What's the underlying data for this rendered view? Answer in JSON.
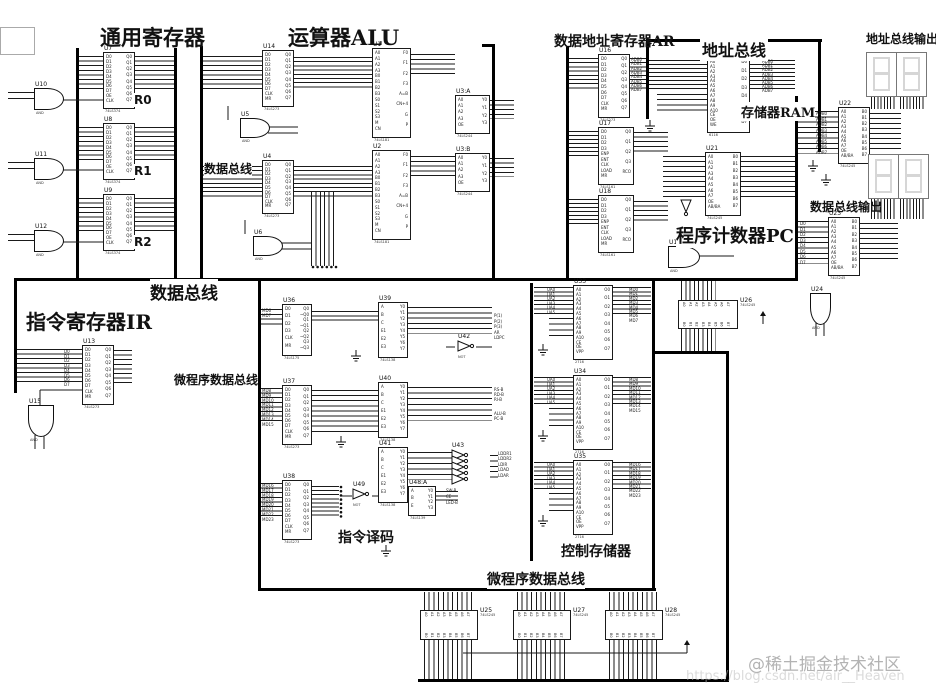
{
  "sections": {
    "gen_reg": "通用寄存器",
    "alu": "运算器ALU",
    "ar": "数据地址寄存器AR",
    "addr_bus": "地址总线",
    "addr_out": "地址总线输出",
    "ram": "存储器RAM",
    "data_bus_small": "数据总线",
    "pc": "程序计数器PC",
    "data_out": "数据总线输出",
    "data_bus": "数据总线",
    "ir": "指令寄存器IR",
    "micro_bus_left": "微程序数据总线",
    "decode": "指令译码",
    "ctrl_store": "控制存储器",
    "micro_bus_bottom": "微程序数据总线",
    "r0": "R0",
    "r1": "R1",
    "r2": "R2"
  },
  "watermark": {
    "community": "@稀土掘金技术社区",
    "url": "https://blog.csdn.net/air__Heaven"
  },
  "chips": [
    {
      "ref": "U7",
      "part": "74LS374",
      "x": 103,
      "y": 52,
      "w": 30,
      "h": 55,
      "lp": "D:0-7,OE,CLK",
      "rp": "Q:0-7"
    },
    {
      "ref": "U8",
      "part": "74LS374",
      "x": 103,
      "y": 123,
      "w": 30,
      "h": 55,
      "lp": "D:0-7,OE,CLK",
      "rp": "Q:0-7"
    },
    {
      "ref": "U9",
      "part": "74LS374",
      "x": 103,
      "y": 194,
      "w": 30,
      "h": 55,
      "lp": "D:0-7,OE,CLK",
      "rp": "Q:0-7"
    },
    {
      "ref": "U14",
      "part": "74LS273",
      "x": 262,
      "y": 50,
      "w": 30,
      "h": 55,
      "lp": "D:0-7,CLK,MR",
      "rp": "Q:0-7"
    },
    {
      "ref": "U4",
      "part": "74LS273",
      "x": 262,
      "y": 160,
      "w": 30,
      "h": 52,
      "lp": "D:0-7,CLK,MR",
      "rp": "Q:0-7"
    },
    {
      "ref": "U1",
      "part": "74LS181",
      "x": 372,
      "y": 48,
      "w": 37,
      "h": 88,
      "lp": "A:0-3,B:0-3,S:0-3,M,CN",
      "rp": "F:0-3,A=B,CN+4,G,P"
    },
    {
      "ref": "U2",
      "part": "74LS181",
      "x": 372,
      "y": 150,
      "w": 37,
      "h": 88,
      "lp": "A:0-3,B:0-3,S:0-3,M,CN",
      "rp": "F:0-3,A=B,CN+4,G,P"
    },
    {
      "ref": "U3:A",
      "part": "74LS244",
      "x": 455,
      "y": 95,
      "w": 33,
      "h": 37,
      "lp": "A:0-3,OE",
      "rp": "Y:0-3"
    },
    {
      "ref": "U3:B",
      "part": "74LS244",
      "x": 455,
      "y": 153,
      "w": 33,
      "h": 37,
      "lp": "A:0-3,OE",
      "rp": "Y:0-3"
    },
    {
      "ref": "U16",
      "part": "74LS273",
      "x": 598,
      "y": 54,
      "w": 30,
      "h": 62,
      "lp": "D:0-7,CLK,MR",
      "rp": "Q:0-7"
    },
    {
      "ref": "U20",
      "part": "6116",
      "x": 707,
      "y": 57,
      "w": 41,
      "h": 74,
      "lp": "A:0-10,CE,OE,WE",
      "rp": "D:0-7"
    },
    {
      "ref": "U17",
      "part": "74LS161",
      "x": 598,
      "y": 127,
      "w": 34,
      "h": 56,
      "lp": "D:0-3,ENP,ENT,CLK,LOAD,MR",
      "rp": "Q:0-3,RCO"
    },
    {
      "ref": "U18",
      "part": "74LS161",
      "x": 598,
      "y": 195,
      "w": 34,
      "h": 56,
      "lp": "D:0-3,ENP,ENT,CLK,LOAD,MR",
      "rp": "Q:0-3,RCO"
    },
    {
      "ref": "U21",
      "part": "74LS245",
      "x": 705,
      "y": 152,
      "w": 34,
      "h": 62,
      "lp": "A:0-7,OE,AB/BA",
      "rp": "B:0-7"
    },
    {
      "ref": "U22",
      "part": "74LS245",
      "x": 838,
      "y": 107,
      "w": 30,
      "h": 55,
      "lp": "A:0-7,OE,AB/BA",
      "rp": "B:0-7"
    },
    {
      "ref": "U23",
      "part": "74LS245",
      "x": 828,
      "y": 217,
      "w": 30,
      "h": 57,
      "lp": "A:0-7,OE,AB/BA",
      "rp": "B:0-7"
    },
    {
      "ref": "U13",
      "part": "74LS273",
      "x": 82,
      "y": 345,
      "w": 30,
      "h": 58,
      "lp": "D:0-7,CLK,MR",
      "rp": "Q:0-7"
    },
    {
      "ref": "U36",
      "part": "74LS175",
      "x": 282,
      "y": 304,
      "w": 28,
      "h": 50,
      "lp": "D:0-3,CLK,MR",
      "rp": "Q0,~Q0,Q1,~Q1,Q2,~Q2,Q3,~Q3"
    },
    {
      "ref": "U37",
      "part": "74LS273",
      "x": 282,
      "y": 385,
      "w": 28,
      "h": 58,
      "lp": "D:0-7,CLK,MR",
      "rp": "Q:0-7"
    },
    {
      "ref": "U38",
      "part": "74LS273",
      "x": 282,
      "y": 480,
      "w": 28,
      "h": 58,
      "lp": "D:0-7,CLK,MR",
      "rp": "Q:0-7"
    },
    {
      "ref": "U39",
      "part": "74LS138",
      "x": 378,
      "y": 302,
      "w": 28,
      "h": 54,
      "lp": "A,B,C,E1,E2,E3",
      "rp": "Y:0-7"
    },
    {
      "ref": "U40",
      "part": "74LS138",
      "x": 378,
      "y": 382,
      "w": 28,
      "h": 54,
      "lp": "A,B,C,E1,E2,E3",
      "rp": "Y:0-7"
    },
    {
      "ref": "U41",
      "part": "74LS138",
      "x": 378,
      "y": 447,
      "w": 28,
      "h": 54,
      "lp": "A,B,C,E1,E2,E3",
      "rp": "Y:0-7"
    },
    {
      "ref": "U48:A",
      "part": "74LS139",
      "x": 408,
      "y": 486,
      "w": 26,
      "h": 28,
      "lp": "A,B,E",
      "rp": "Y:0-3"
    },
    {
      "ref": "U33",
      "part": "2716",
      "x": 573,
      "y": 285,
      "w": 38,
      "h": 73,
      "lp": "A:0-10,CE,OE,VPP",
      "rp": "O:0-7"
    },
    {
      "ref": "U34",
      "part": "2716",
      "x": 573,
      "y": 375,
      "w": 38,
      "h": 73,
      "lp": "A:0-10,CE,OE,VPP",
      "rp": "O:0-7"
    },
    {
      "ref": "U35",
      "part": "2716",
      "x": 573,
      "y": 460,
      "w": 38,
      "h": 73,
      "lp": "A:0-10,CE,OE,VPP",
      "rp": "O:0-7"
    },
    {
      "ref": "U26",
      "part": "74LS245",
      "x": 678,
      "y": 300,
      "w": 58,
      "h": 27,
      "dir": "h",
      "tp": "A:0-7",
      "bp": "B:0-7"
    },
    {
      "ref": "U25",
      "part": "74LS245",
      "x": 420,
      "y": 610,
      "w": 56,
      "h": 28,
      "dir": "h",
      "tp": "A:0-7",
      "bp": "B:0-7"
    },
    {
      "ref": "U27",
      "part": "74LS245",
      "x": 513,
      "y": 610,
      "w": 56,
      "h": 28,
      "dir": "h",
      "tp": "A:0-7",
      "bp": "B:0-7"
    },
    {
      "ref": "U28",
      "part": "74LS245",
      "x": 605,
      "y": 610,
      "w": 56,
      "h": 28,
      "dir": "h",
      "tp": "A:0-7",
      "bp": "B:0-7"
    }
  ],
  "gates": [
    {
      "ref": "U10",
      "sub": "AND",
      "x": 34,
      "y": 88,
      "w": 28,
      "h": 20,
      "dir": "r"
    },
    {
      "ref": "U11",
      "sub": "AND",
      "x": 34,
      "y": 158,
      "w": 28,
      "h": 20,
      "dir": "r"
    },
    {
      "ref": "U12",
      "sub": "AND",
      "x": 34,
      "y": 230,
      "w": 28,
      "h": 20,
      "dir": "r"
    },
    {
      "ref": "U5",
      "sub": "AND",
      "x": 240,
      "y": 118,
      "w": 28,
      "h": 18,
      "dir": "r"
    },
    {
      "ref": "U6",
      "sub": "AND",
      "x": 253,
      "y": 236,
      "w": 28,
      "h": 18,
      "dir": "r"
    },
    {
      "ref": "U15",
      "sub": "AND",
      "x": 28,
      "y": 405,
      "w": 24,
      "h": 30,
      "dir": "d"
    },
    {
      "ref": "U19",
      "sub": "AND",
      "x": 668,
      "y": 246,
      "w": 30,
      "h": 20,
      "dir": "r"
    },
    {
      "ref": "U24",
      "sub": "AND",
      "x": 810,
      "y": 293,
      "w": 19,
      "h": 30,
      "dir": "d"
    }
  ],
  "nots": [
    {
      "ref": "U42",
      "sub": "NOT",
      "x": 458,
      "y": 341,
      "dir": "r"
    },
    {
      "ref": "U49",
      "sub": "NOT",
      "x": 353,
      "y": 489,
      "dir": "r"
    },
    {
      "ref": "U43",
      "sub": "NOT",
      "x": 452,
      "y": 450,
      "dir": "r"
    },
    {
      "ref": "",
      "sub": "",
      "x": 452,
      "y": 456,
      "dir": "r"
    },
    {
      "ref": "",
      "sub": "",
      "x": 452,
      "y": 462,
      "dir": "r"
    },
    {
      "ref": "",
      "sub": "",
      "x": 452,
      "y": 468,
      "dir": "r"
    },
    {
      "ref": "",
      "sub": "",
      "x": 452,
      "y": 474,
      "dir": "r"
    },
    {
      "ref": "",
      "sub": "",
      "x": 681,
      "y": 200,
      "dir": "d"
    }
  ],
  "signal_groups": [
    {
      "x": 631,
      "y": 58,
      "p": 4.3,
      "labels": "ADB:0-7"
    },
    {
      "x": 762,
      "y": 60,
      "p": 4.2,
      "labels": "ADB:0-7"
    },
    {
      "x": 816,
      "y": 112,
      "p": 5.5,
      "labels": "ADB:0-7"
    },
    {
      "x": 800,
      "y": 222,
      "p": 5.5,
      "labels": "D:0-7"
    },
    {
      "x": 547,
      "y": 288,
      "p": 4.5,
      "labels": "UA:0-5"
    },
    {
      "x": 547,
      "y": 378,
      "p": 4.5,
      "labels": "UA:0-5"
    },
    {
      "x": 547,
      "y": 463,
      "p": 4.5,
      "labels": "UA:0-5"
    },
    {
      "x": 629,
      "y": 288,
      "p": 4.4,
      "labels": "MD:0-7"
    },
    {
      "x": 629,
      "y": 378,
      "p": 4.4,
      "labels": "MD:8-15"
    },
    {
      "x": 629,
      "y": 463,
      "p": 4.4,
      "labels": "MD:16-23"
    },
    {
      "x": 262,
      "y": 309,
      "p": 5,
      "labels": "MD6,MD7"
    },
    {
      "x": 262,
      "y": 389,
      "p": 4.8,
      "labels": "MD:8-15"
    },
    {
      "x": 262,
      "y": 484,
      "p": 4.8,
      "labels": "MD:16-23"
    },
    {
      "x": 494,
      "y": 314,
      "p": 5.5,
      "labels": "P(1),P(2),P(3),AR,LDPC"
    },
    {
      "x": 494,
      "y": 388,
      "p": 5,
      "labels": "RS-B,RD-B,RI-B"
    },
    {
      "x": 494,
      "y": 412,
      "p": 5,
      "labels": "ALU-B,PC-B"
    },
    {
      "x": 498,
      "y": 452,
      "p": 5.4,
      "labels": "LDDR1,LDDR2,LDIR,LDAD,LDAR"
    },
    {
      "x": 446,
      "y": 489,
      "p": 6,
      "labels": "SW-B,CE,LED-B"
    },
    {
      "x": 64,
      "y": 350,
      "p": 4.7,
      "labels": "D:0-7"
    }
  ],
  "displays": [
    {
      "x": 866,
      "y": 52,
      "w": 29,
      "h": 43
    },
    {
      "x": 896,
      "y": 52,
      "w": 29,
      "h": 43
    },
    {
      "x": 868,
      "y": 154,
      "w": 29,
      "h": 43
    },
    {
      "x": 898,
      "y": 154,
      "w": 29,
      "h": 43
    }
  ]
}
